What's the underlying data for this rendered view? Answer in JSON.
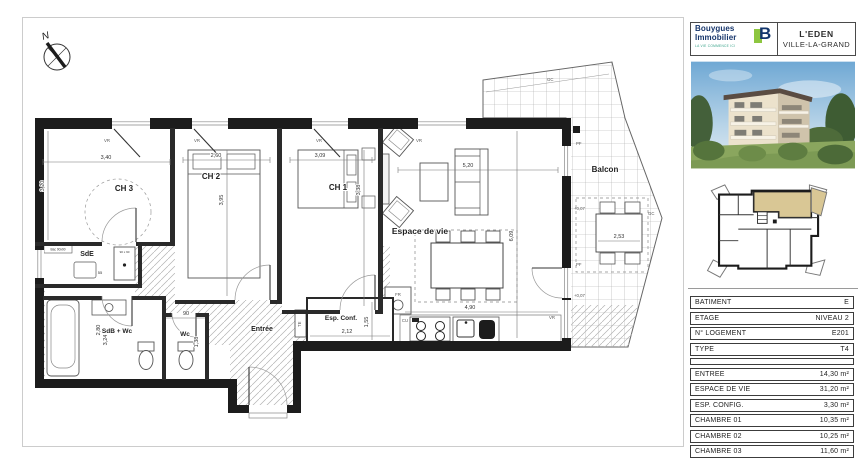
{
  "brand": {
    "name_line1": "Bouygues",
    "name_line2": "Immobilier",
    "tagline": "LA VIE COMMENCE ICI",
    "logo_letter": "B"
  },
  "project": {
    "name": "L'EDEN",
    "city": "VILLE-LA-GRAND"
  },
  "unit_info": {
    "rows": [
      {
        "label": "BATIMENT",
        "value": "E"
      },
      {
        "label": "ETAGE",
        "value": "NIVEAU 2"
      },
      {
        "label": "N° LOGEMENT",
        "value": "E201"
      },
      {
        "label": "TYPE",
        "value": "T4"
      }
    ]
  },
  "areas": {
    "rows": [
      {
        "label": "ENTREE",
        "value": "14,30 m²"
      },
      {
        "label": "ESPACE DE VIE",
        "value": "31,20 m²"
      },
      {
        "label": "ESP. CONFIG.",
        "value": "3,30 m²"
      },
      {
        "label": "CHAMBRE 01",
        "value": "10,35 m²"
      },
      {
        "label": "CHAMBRE 02",
        "value": "10,25 m²"
      },
      {
        "label": "CHAMBRE 03",
        "value": "11,60 m²"
      }
    ]
  },
  "plan": {
    "north": "N",
    "rooms": {
      "ch1": "CH 1",
      "ch2": "CH 2",
      "ch3": "CH 3",
      "living": "Espace de vie",
      "entrance": "Entrée",
      "esp_conf": "Esp. Conf.",
      "sde": "SdE",
      "sdb_wc": "SdB + Wc",
      "wc": "Wc",
      "balcony": "Balcon"
    },
    "dimensions": {
      "ch3_width": "3,40",
      "ch3_depth": "3,20",
      "ch2_width": "2,60",
      "ch2_depth": "3,95",
      "ch1_width": "3,09",
      "ch1_depth": "3,38",
      "living_width": "5,20",
      "living_depth": "6,09",
      "kitchen_width": "4,90",
      "esp_conf_width": "2,12",
      "esp_conf_depth": "1,55",
      "sdb_width": "2,80",
      "sdb_depth": "3,24",
      "wc_width": "90",
      "wc_depth": "1,38",
      "balcony_table": "2,53",
      "shower_label": "Bac 90x90",
      "shower_size": "90 x 90",
      "sde_dim": "55"
    },
    "tags": {
      "vr": "VR",
      "pf": "PF",
      "te": "TE",
      "cu": "CU",
      "fr": "FR",
      "gc": "GC",
      "level": "+0,07"
    }
  },
  "colors": {
    "accent_green": "#8dc63f",
    "brand_navy": "#16356b",
    "unit_highlight": "#d9c795",
    "wall_black": "#1c1c1c"
  }
}
